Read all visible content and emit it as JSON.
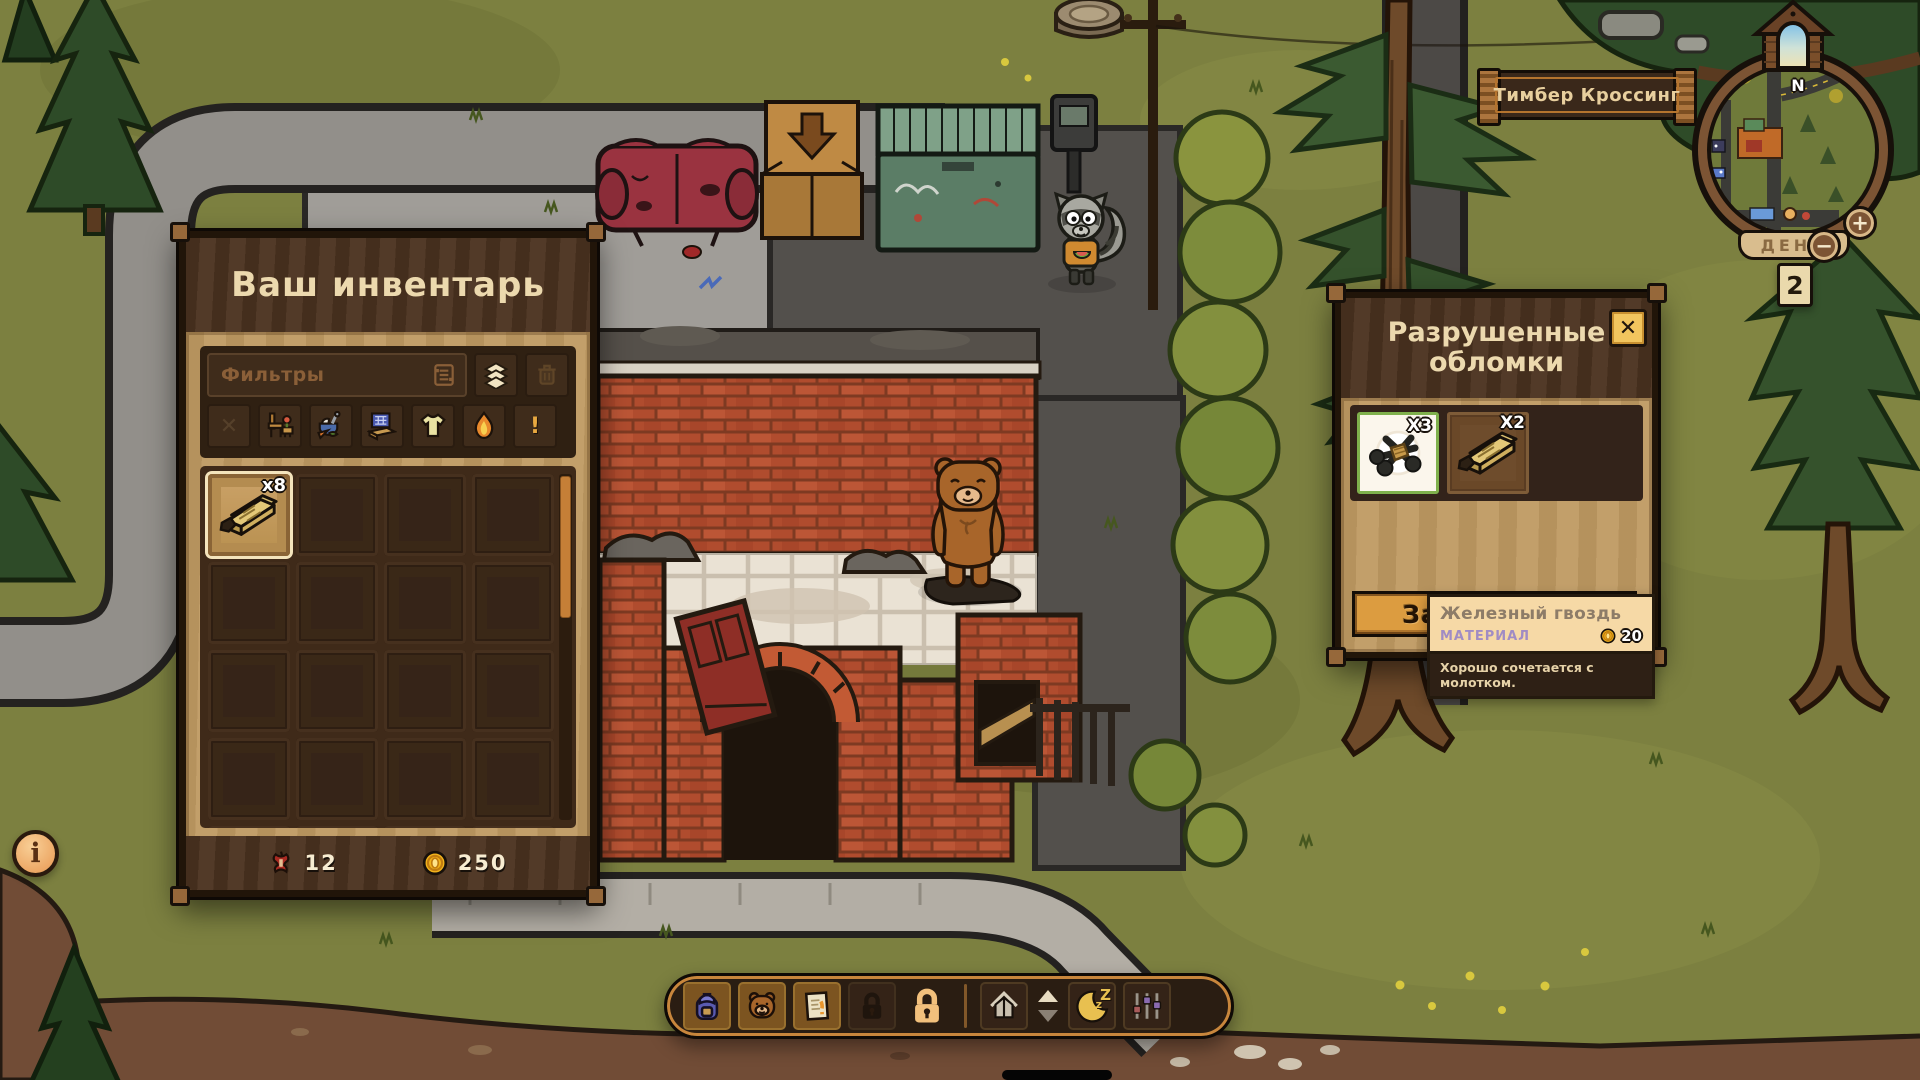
{
  "ui": {
    "inventory": {
      "title": "Ваш инвентарь",
      "filters_label": "Фильтры",
      "filter_glyphs": {
        "clear": "✕",
        "quest": "!"
      },
      "grid": {
        "columns": 4,
        "rows": 5
      },
      "selected_item": {
        "name": "planks",
        "count_label": "x8"
      },
      "footer": {
        "apple_count": "12",
        "coin_count": "250"
      }
    },
    "loot": {
      "title": "Разрушенные обломки",
      "close_glyph": "✕",
      "items": [
        {
          "name": "iron-nail",
          "count_label": "X3",
          "selected": true
        },
        {
          "name": "plank",
          "count_label": "X2",
          "selected": false
        }
      ],
      "tooltip": {
        "title": "Железный гвоздь",
        "category": "МАТЕРИАЛ",
        "price": "20",
        "note": "Хорошо сочетается с молотком."
      },
      "take_all_label": "Забрать все"
    },
    "location_banner": "Тимбер Кроссинг",
    "minimap": {
      "north_label": "N",
      "day_label": "ДЕНЬ",
      "day_value": "2",
      "zoom_in_label": "+",
      "zoom_out_label": "−"
    },
    "toolbar": {
      "sleep_z_large": "Z",
      "sleep_z_small": "z"
    },
    "info_label": "i"
  },
  "colors": {
    "accent_orange": "#c8863c",
    "panel_wood": "#4c3320",
    "panel_tan": "#bf9a62",
    "cream_text": "#ecd9ae",
    "button_orange": "#dc9c40",
    "selected_green": "#7fb04c",
    "category_lavender": "#a08cc4"
  }
}
